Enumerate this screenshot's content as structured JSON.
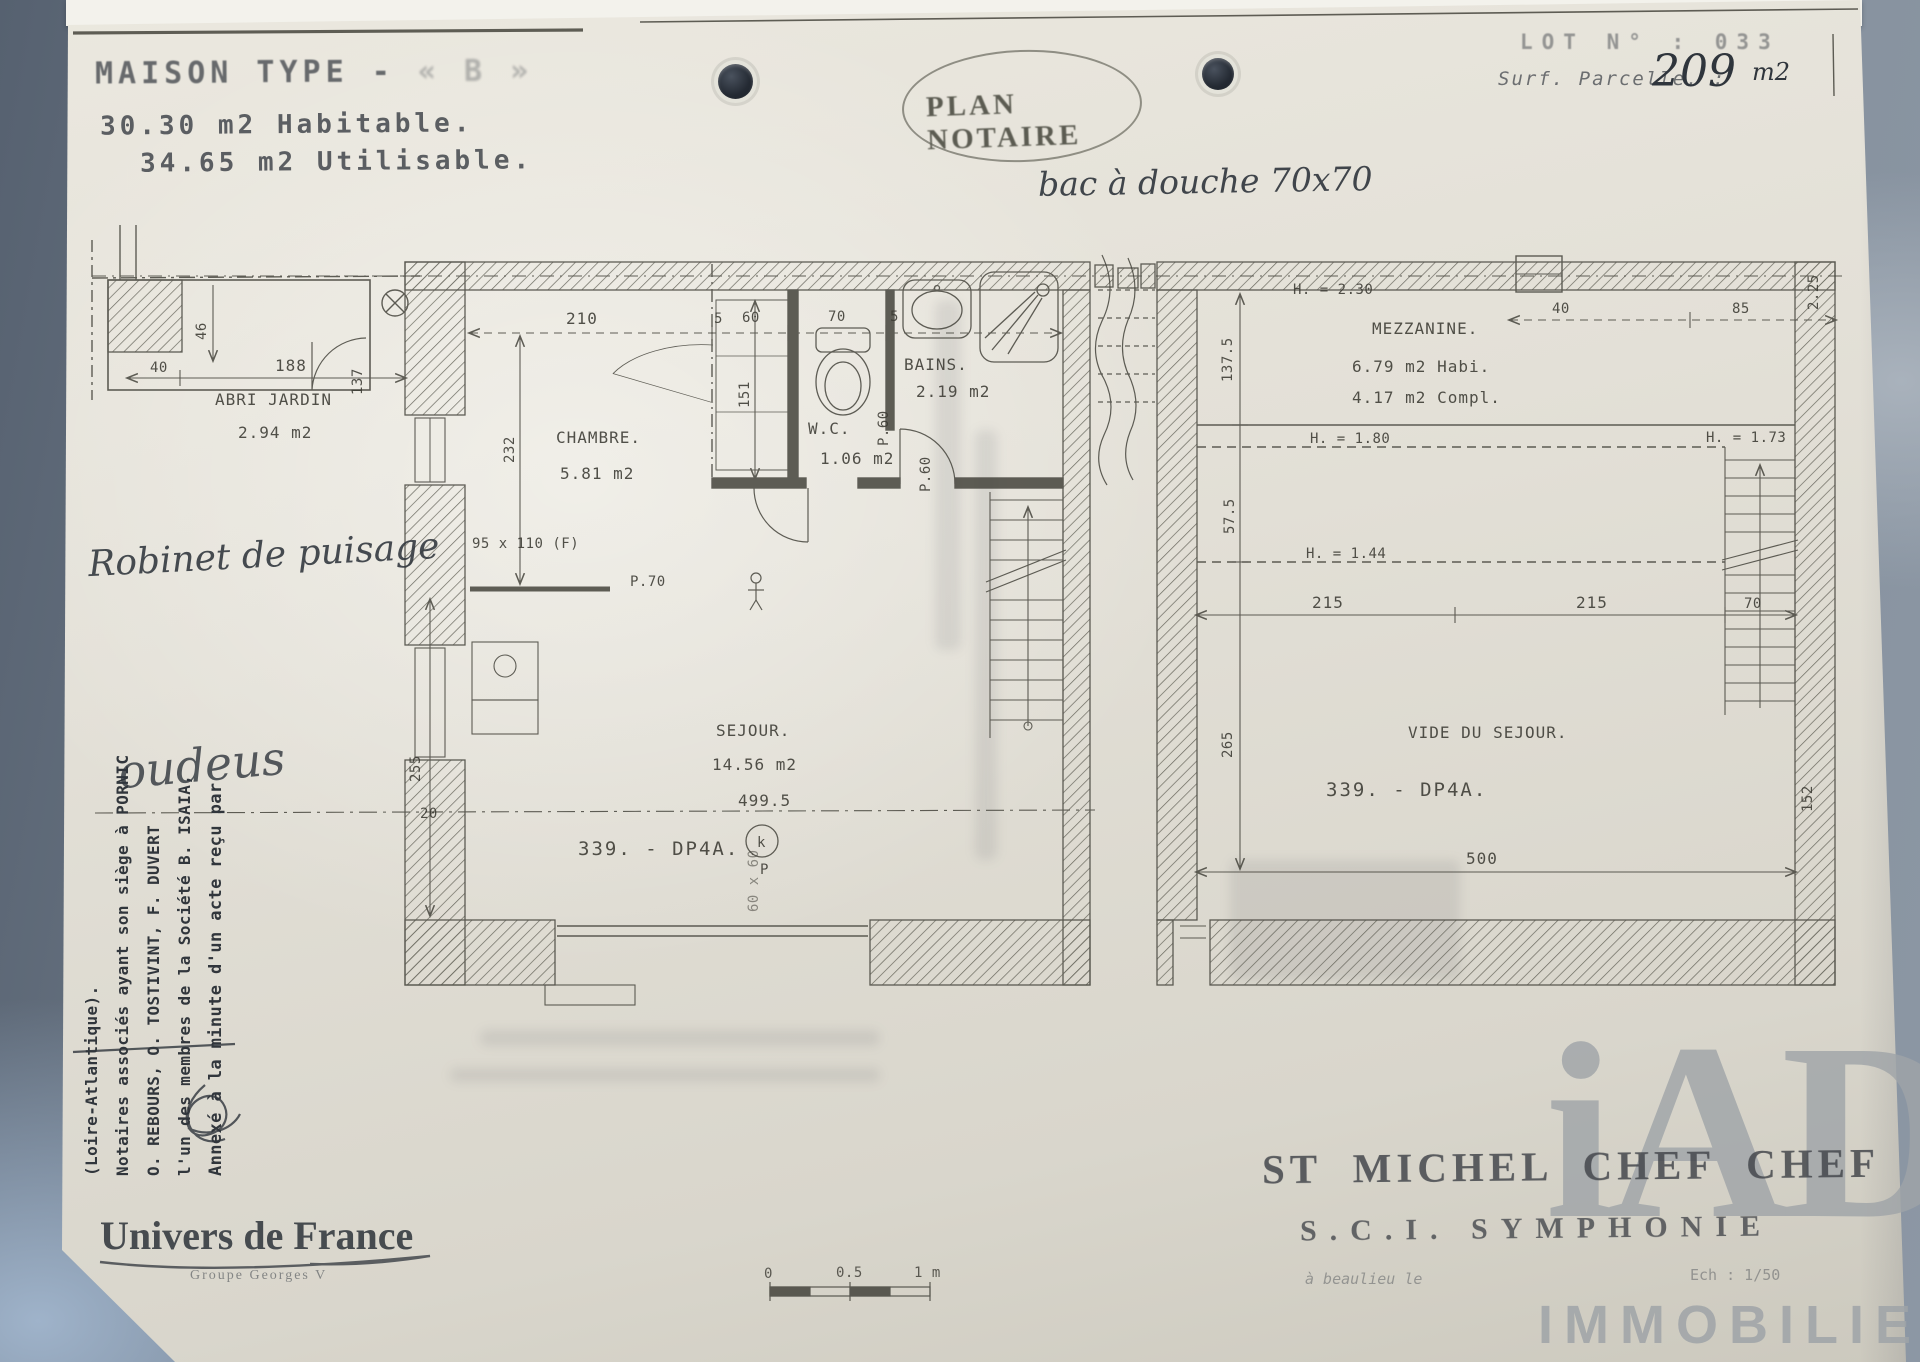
{
  "colors": {
    "paper": "#e3e0d7",
    "backdrop": "#76828f",
    "ink": "#3b3a33",
    "watermark_gray": "#9fa4a8"
  },
  "header": {
    "title": "MAISON TYPE  -",
    "title_faded": "« B »",
    "hab": "30.30 m2 Habitable.",
    "util": "34.65 m2 Utilisable.",
    "stamp": "PLAN NOTAIRE",
    "lot": "LOT N° : 033",
    "parcel_label": "Surf. Parcelle. :",
    "parcel_number": "209",
    "parcel_unit": "m2",
    "note": "bac à douche 70x70"
  },
  "gf": {
    "abri_label": "ABRI JARDIN",
    "abri_area": "2.94 m2",
    "chambre": "CHAMBRE.",
    "chambre_area": "5.81 m2",
    "wc": "W.C.",
    "wc_area": "1.06 m2",
    "bains": "BAINS.",
    "bains_area": "2.19 m2",
    "sejour": "SEJOUR.",
    "sejour_area": "14.56 m2",
    "ref": "339. - DP4A.",
    "ref_symbol": "k",
    "p_label": "P",
    "window": "95 x 110 (F)",
    "d210": "210",
    "d5a": "5",
    "d60": "60",
    "d70": "70",
    "d5b": "5",
    "d46": "46",
    "d40": "40",
    "d188": "188",
    "d137": "137",
    "d232": "232",
    "d151": "151",
    "d255": "255",
    "d20": "20",
    "d4995": "499.5",
    "p70": "P.70",
    "p60a": "P.60",
    "p60b": "P.60",
    "d60x60": "60 x 60"
  },
  "mz": {
    "name": "MEZZANINE.",
    "area1": "6.79 m2 Habi.",
    "area2": "4.17 m2 Compl.",
    "vide": "VIDE DU SEJOUR.",
    "ref": "339. - DP4A.",
    "h230": "H. = 2.30",
    "h180": "H. = 1.80",
    "h144": "H. = 1.44",
    "h173": "H. = 1.73",
    "d40": "40",
    "d85": "85",
    "d225": "2.25",
    "d1375": "137.5",
    "d575": "57.5",
    "d265": "265",
    "d215a": "215",
    "d215b": "215",
    "d70": "70",
    "d500": "500",
    "d152": "152"
  },
  "margin": {
    "lines": [
      "Annexé à la minute d'un acte reçu par",
      "l'un des membres de la Société B. ISAIA,",
      "O. REBOURS, O. TOSTIVINT, F. DUVERT",
      "Notaires associés ayant son siège à PORNIC",
      "(Loire-Atlantique)."
    ],
    "annotation": "oudeus",
    "tap_note": "Robinet de puisage"
  },
  "footer": {
    "letterhead": "Univers de France",
    "letterhead_sub": "Groupe Georges V",
    "city": "ST MICHEL CHEF CHEF",
    "company": "S.C.I. SYMPHONIE",
    "small_left": "à beaulieu le",
    "small_right": "Ech : 1/50",
    "scale0": "0",
    "scale05": "0.5",
    "scale1": "1 m"
  },
  "watermark": {
    "logo": "iAD",
    "text": "IMMOBILIER"
  }
}
